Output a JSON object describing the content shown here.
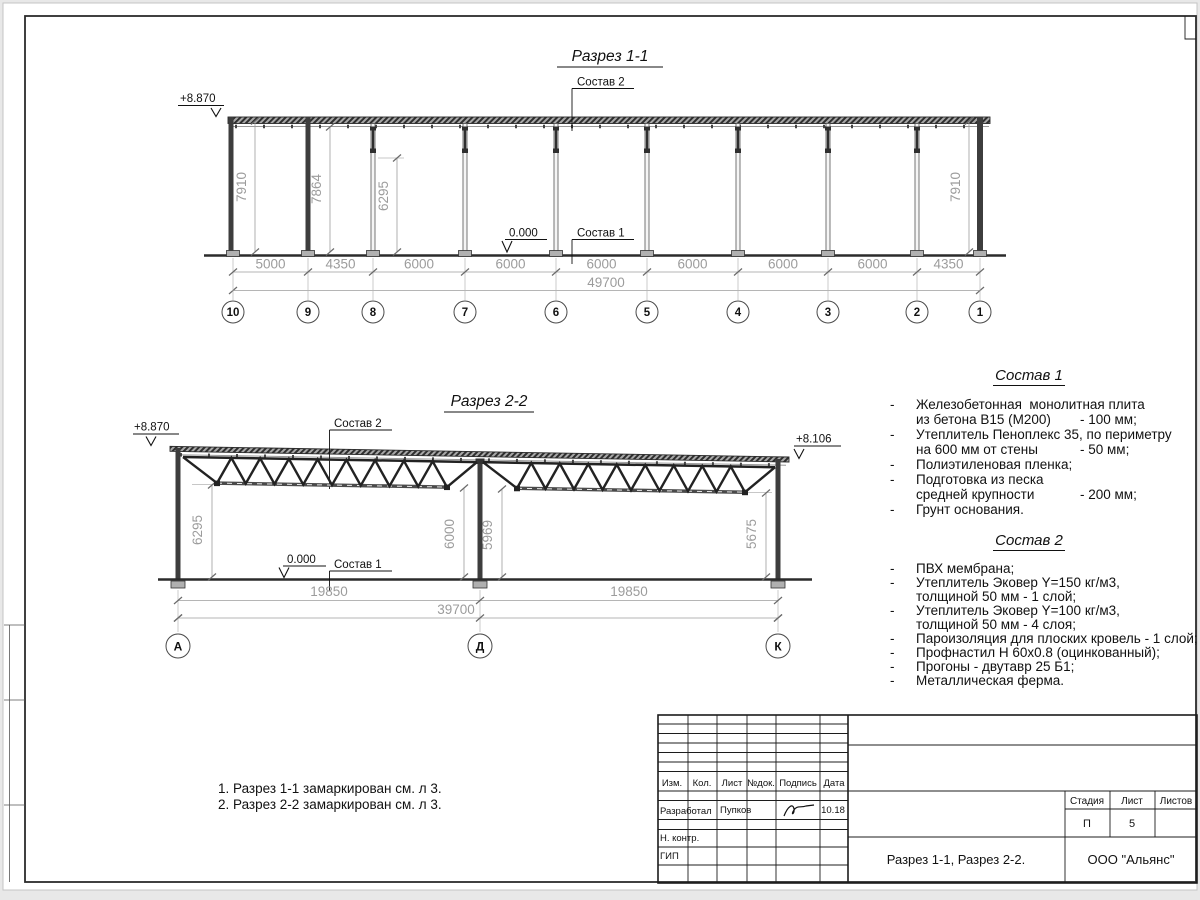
{
  "page": {
    "bg": "#e8e8e8",
    "sheet": "#ffffff",
    "line_color": "#2b2b2b",
    "dim_color": "#9c9c9c"
  },
  "s11": {
    "title": "Разрез 1-1",
    "elevation_left": "+8.870",
    "zero_mark": "0.000",
    "label_top": "Состав 2",
    "label_floor": "Состав 1",
    "dims_bottom": [
      "5000",
      "4350",
      "6000",
      "6000",
      "6000",
      "6000",
      "6000",
      "6000",
      "4350"
    ],
    "dim_total": "49700",
    "dims_vertical": [
      "7910",
      "7864",
      "6295",
      "7910"
    ],
    "axes": [
      "10",
      "9",
      "8",
      "7",
      "6",
      "5",
      "4",
      "3",
      "2",
      "1"
    ]
  },
  "s22": {
    "title": "Разрез 2-2",
    "elevation_left": "+8.870",
    "elevation_right": "+8.106",
    "zero_mark": "0.000",
    "label_top": "Состав 2",
    "label_floor": "Состав 1",
    "dims_bottom": [
      "19850",
      "19850"
    ],
    "dim_total": "39700",
    "dims_vertical": [
      "6295",
      "6000",
      "5969",
      "5675"
    ],
    "axes": [
      "А",
      "Д",
      "К"
    ]
  },
  "spec1": {
    "title": "Состав 1",
    "rows": [
      {
        "b": "-",
        "t": "Железобетонная  монолитная плита",
        "v": ""
      },
      {
        "b": "",
        "t": "из бетона В15 (М200)",
        "v": "- 100 мм;"
      },
      {
        "b": "-",
        "t": "Утеплитель Пеноплекс 35, по периметру",
        "v": ""
      },
      {
        "b": "",
        "t": "на 600 мм от стены",
        "v": "- 50 мм;"
      },
      {
        "b": "-",
        "t": "Полиэтиленовая пленка;",
        "v": ""
      },
      {
        "b": "-",
        "t": "Подготовка из песка",
        "v": ""
      },
      {
        "b": "",
        "t": "средней крупности",
        "v": "- 200 мм;"
      },
      {
        "b": "-",
        "t": "Грунт основания.",
        "v": ""
      }
    ]
  },
  "spec2": {
    "title": "Состав 2",
    "rows": [
      {
        "b": "-",
        "t": "ПВХ мембрана;",
        "v": ""
      },
      {
        "b": "-",
        "t": "Утеплитель Эковер Y=150 кг/м3,",
        "v": ""
      },
      {
        "b": "",
        "t": "толщиной 50 мм - 1 слой;",
        "v": ""
      },
      {
        "b": "-",
        "t": "Утеплитель Эковер Y=100 кг/м3,",
        "v": ""
      },
      {
        "b": "",
        "t": "толщиной 50 мм - 4 слоя;",
        "v": ""
      },
      {
        "b": "-",
        "t": "Пароизоляция для плоских кровель - 1 слой;",
        "v": ""
      },
      {
        "b": "-",
        "t": "Профнастил Н 60х0.8 (оцинкованный);",
        "v": ""
      },
      {
        "b": "-",
        "t": "Прогоны - двутавр 25 Б1;",
        "v": ""
      },
      {
        "b": "-",
        "t": "Металлическая ферма.",
        "v": ""
      }
    ]
  },
  "notes": [
    "1. Разрез 1-1 замаркирован см. л 3.",
    "2. Разрез 2-2 замаркирован см. л 3."
  ],
  "tb": {
    "h": [
      "Изм.",
      "Кол.",
      "Лист",
      "№док.",
      "Подпись",
      "Дата"
    ],
    "developed_label": "Разработал",
    "developed_name": "Пупков",
    "developed_date": "10.18",
    "ncontrol_label": "Н. контр.",
    "gip_label": "ГИП",
    "stage_label": "Стадия",
    "sheet_label": "Лист",
    "sheets_label": "Листов",
    "stage": "П",
    "sheet_no": "5",
    "sheets_total": "",
    "doc_title": "Разрез 1-1, Разрез 2-2.",
    "company": "ООО \"Альянс\""
  }
}
